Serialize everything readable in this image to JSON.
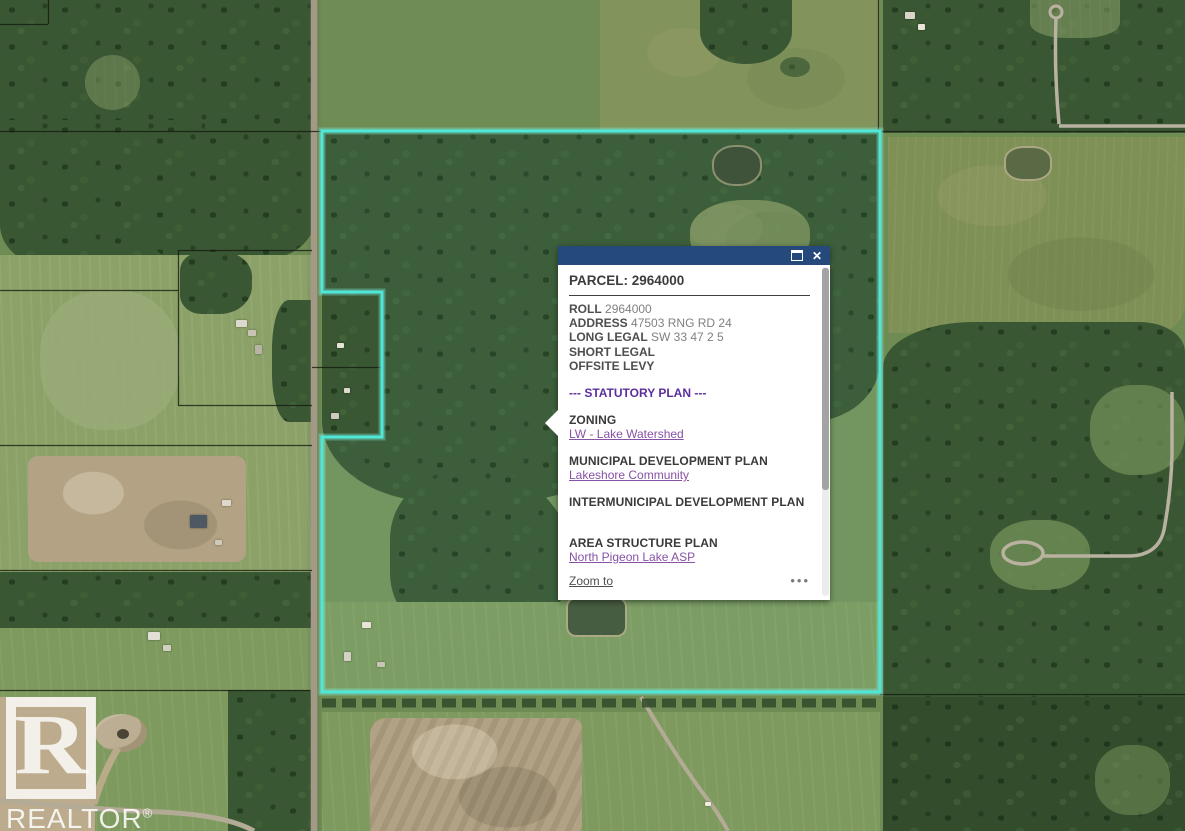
{
  "map": {
    "accent_color": "#4FE8D8",
    "boundary_name": "parcel-2964000-boundary",
    "watermark": {
      "letter": "R",
      "label": "REALTOR",
      "reg": "®"
    }
  },
  "popup": {
    "header_color": "#26497C",
    "icons": {
      "maximize": "maximize-icon",
      "close": "✕",
      "more": "•••"
    },
    "title": "PARCEL: 2964000",
    "fields": [
      {
        "label": "ROLL",
        "value": "2964000"
      },
      {
        "label": "ADDRESS",
        "value": "47503 RNG RD 24"
      },
      {
        "label": "LONG LEGAL",
        "value": "SW 33 47 2 5"
      },
      {
        "label": "SHORT LEGAL",
        "value": ""
      },
      {
        "label": "OFFSITE LEVY",
        "value": ""
      }
    ],
    "section_divider": "--- STATUTORY PLAN ---",
    "statutory_color": "#5C2E9C",
    "link_color": "#8752A5",
    "sections": [
      {
        "heading": "ZONING",
        "link": "LW - Lake Watershed"
      },
      {
        "heading": "MUNICIPAL DEVELOPMENT PLAN",
        "link": "Lakeshore Community"
      },
      {
        "heading": "INTERMUNICIPAL DEVELOPMENT PLAN",
        "link": ""
      },
      {
        "heading": "AREA STRUCTURE PLAN",
        "link": "North Pigeon Lake ASP"
      }
    ],
    "footer": {
      "zoom_to": "Zoom to",
      "more": "•••"
    }
  }
}
